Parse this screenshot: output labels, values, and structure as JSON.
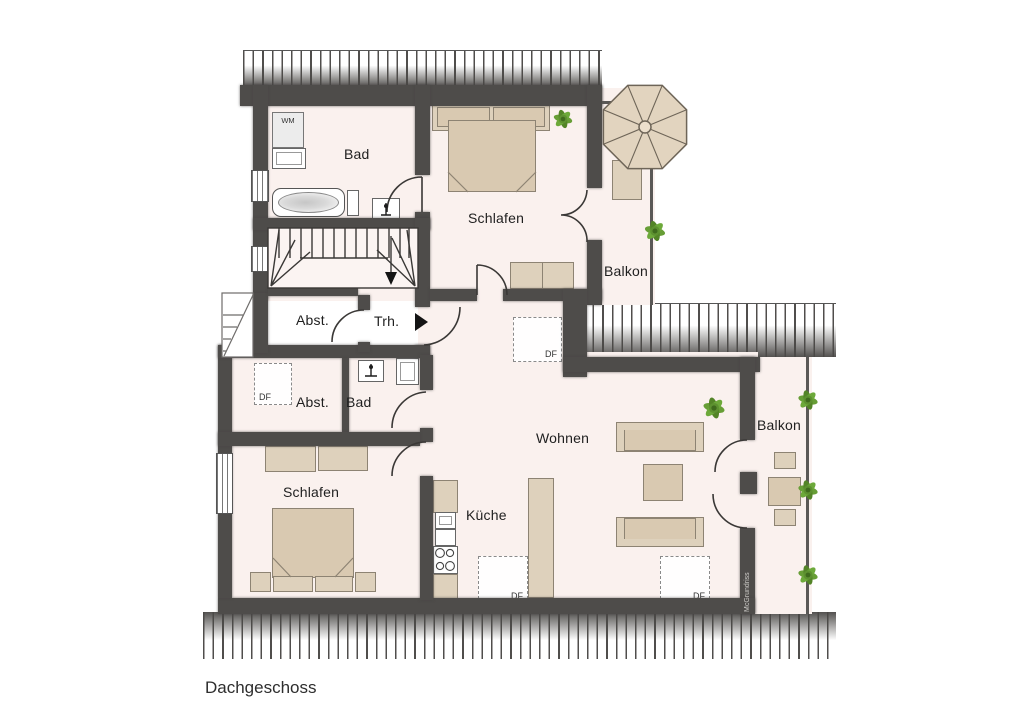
{
  "title": "Dachgeschoss",
  "watermark": "McGrundriss",
  "rooms": {
    "bad_top": {
      "label": "Bad"
    },
    "schlafen_top": {
      "label": "Schlafen"
    },
    "balkon_top": {
      "label": "Balkon"
    },
    "abst_top": {
      "label": "Abst."
    },
    "treppenhaus": {
      "label": "Trh."
    },
    "abst_bottom": {
      "label": "Abst."
    },
    "bad_bottom": {
      "label": "Bad"
    },
    "wohnen": {
      "label": "Wohnen"
    },
    "kueche": {
      "label": "Küche"
    },
    "schlafen_bottom": {
      "label": "Schlafen"
    },
    "balkon_right": {
      "label": "Balkon"
    }
  },
  "fixtures": {
    "washing_machine": "WM",
    "roof_window": "DF"
  },
  "colors": {
    "wall": "#4e4c4a",
    "floor": "#faf1ee",
    "furniture": "#ded1bc",
    "furniture_dark": "#d9c9b1",
    "plant_green": "#5d9130",
    "outline": "#3a3836"
  }
}
